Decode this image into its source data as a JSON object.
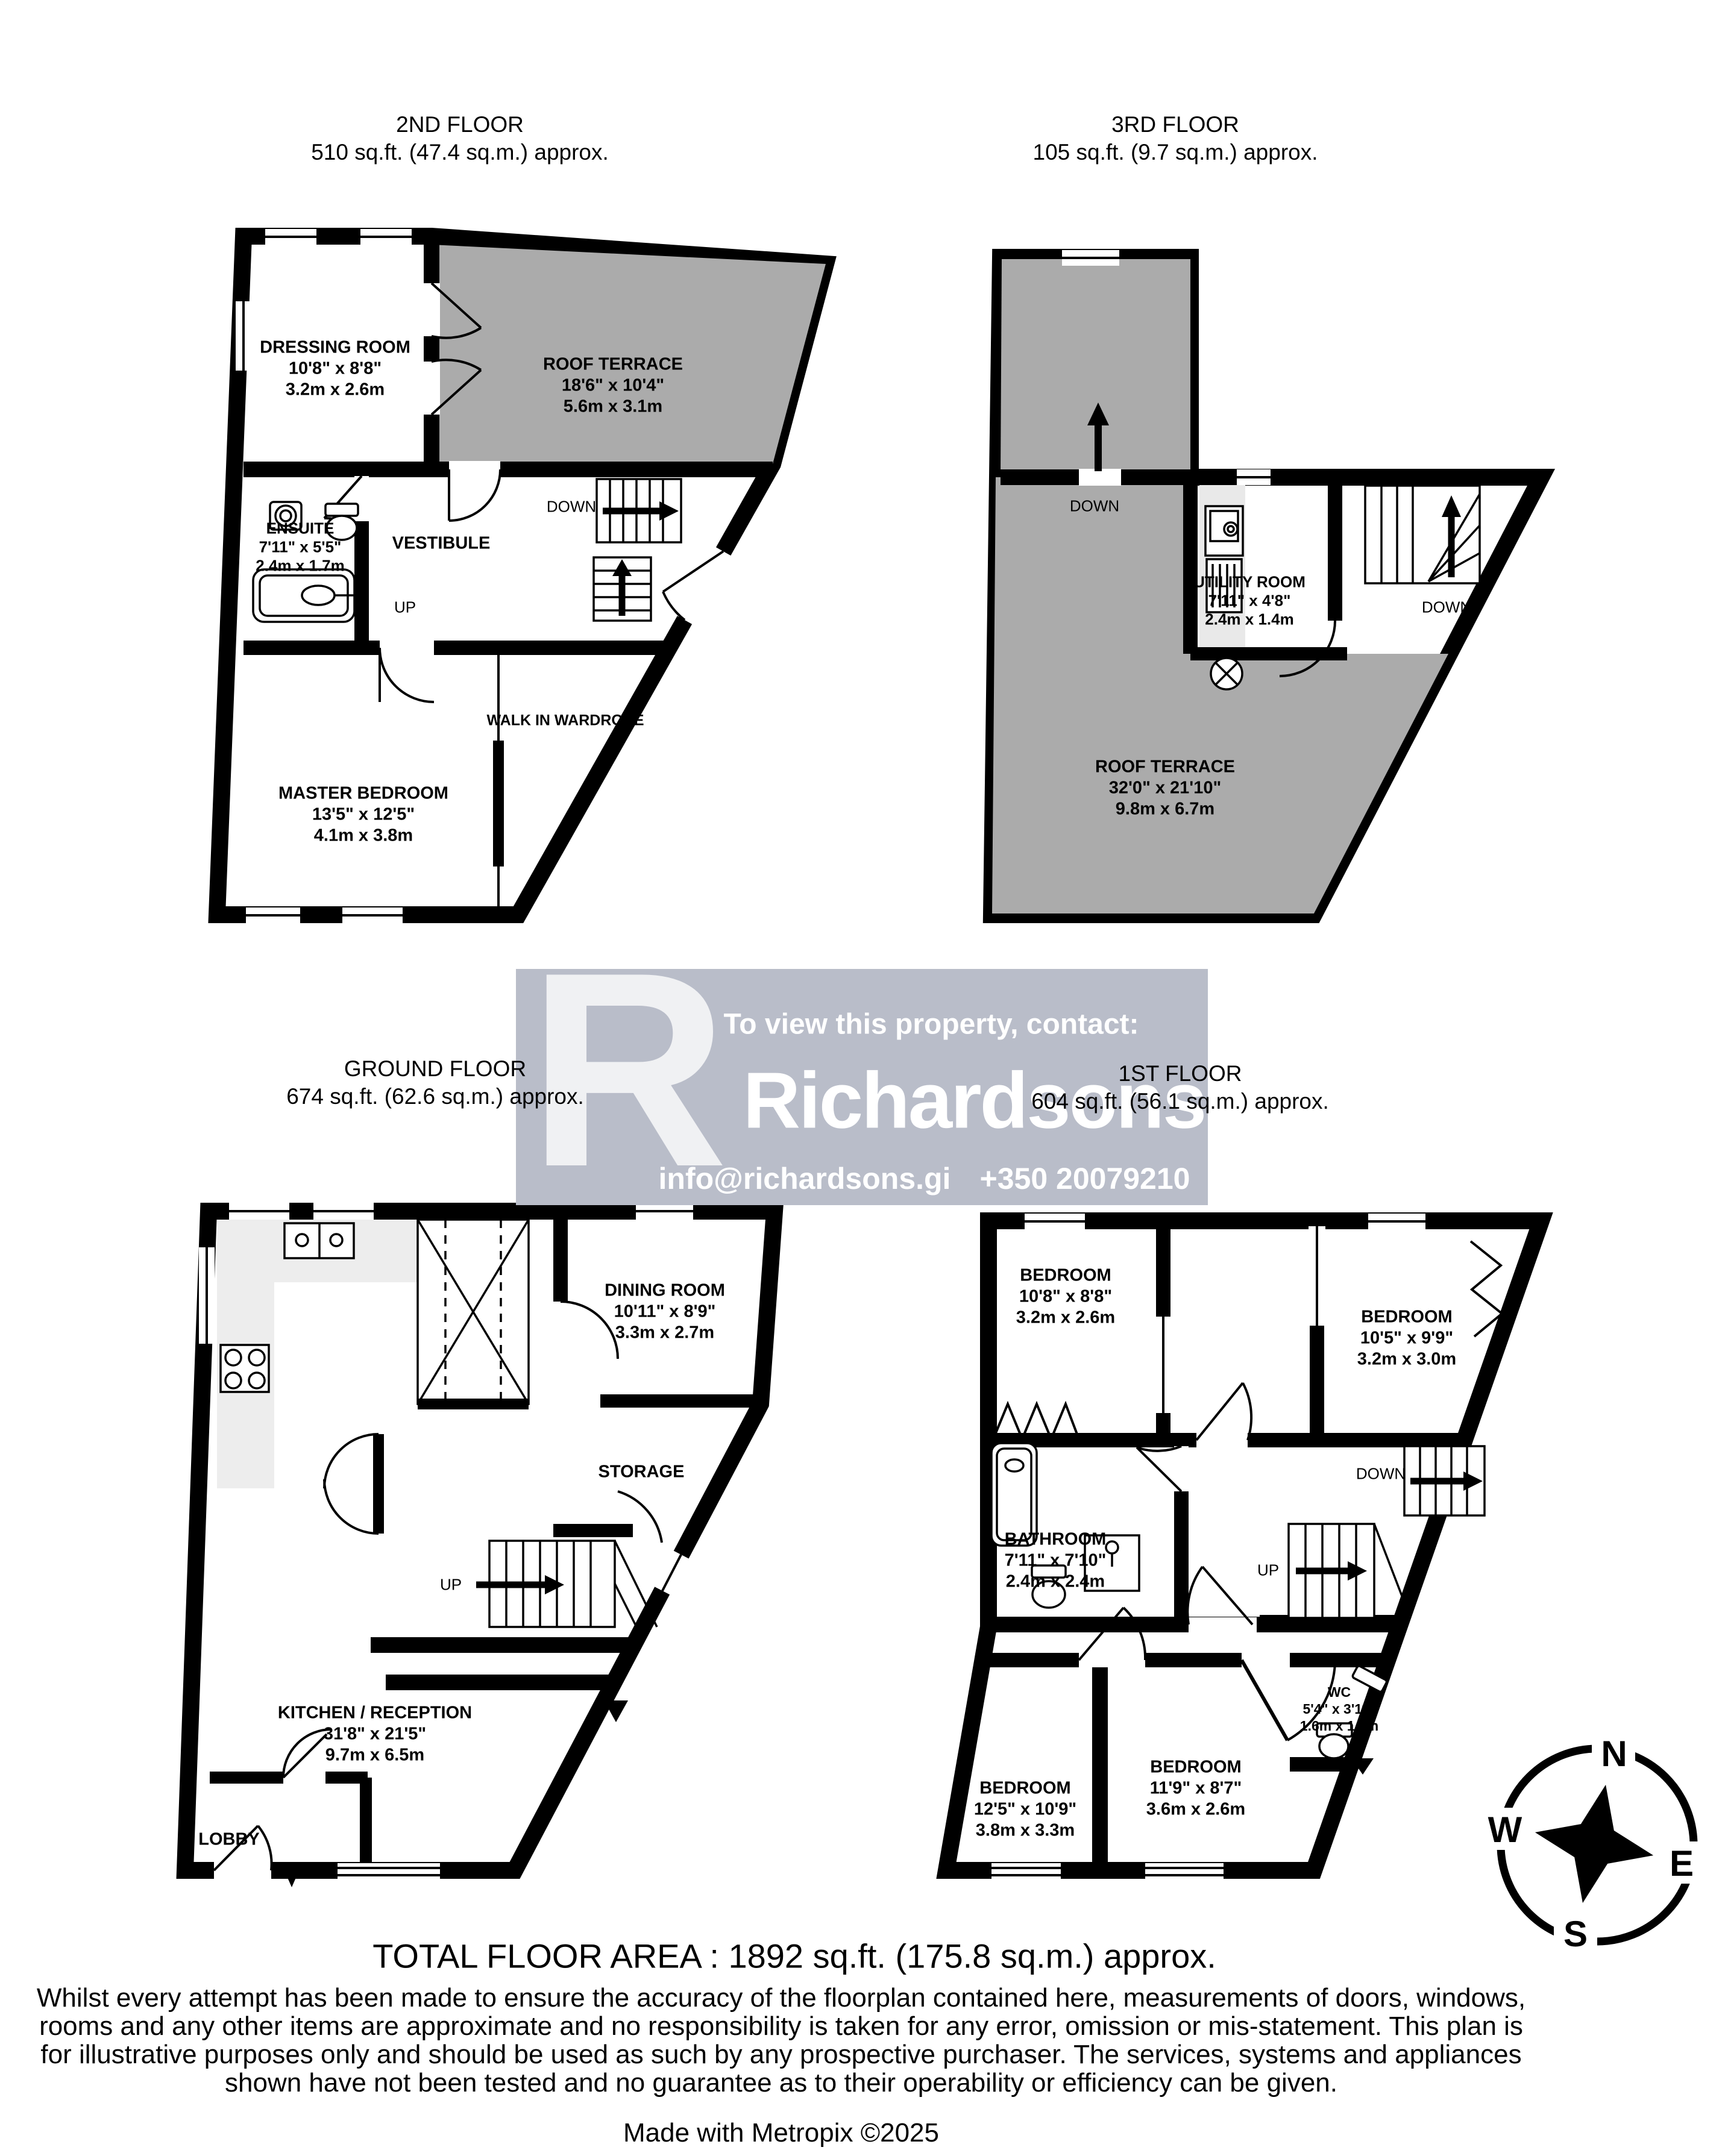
{
  "floors": [
    {
      "label": "2ND FLOOR",
      "area": "510 sq.ft. (47.4 sq.m.) approx.",
      "rooms": {
        "dressing": {
          "name": "DRESSING ROOM",
          "ft": "10'8\"  x 8'8\"",
          "m": "3.2m  x 2.6m"
        },
        "terrace": {
          "name": "ROOF TERRACE",
          "ft": "18'6\"  x 10'4\"",
          "m": "5.6m  x 3.1m"
        },
        "ensuite": {
          "name": "ENSUITE",
          "ft": "7'11\"  x 5'5\"",
          "m": "2.4m  x 1.7m"
        },
        "vestibule": {
          "name": "VESTIBULE"
        },
        "wardrobe": {
          "name": "WALK IN WARDROBE"
        },
        "master": {
          "name": "MASTER BEDROOM",
          "ft": "13'5\"  x 12'5\"",
          "m": "4.1m  x 3.8m"
        }
      },
      "annotations": {
        "down": "DOWN",
        "up": "UP"
      }
    },
    {
      "label": "3RD FLOOR",
      "area": "105 sq.ft. (9.7 sq.m.) approx.",
      "rooms": {
        "utility": {
          "name": "UTILITY ROOM",
          "ft": "7'11\"  x 4'8\"",
          "m": "2.4m  x 1.4m"
        },
        "terrace": {
          "name": "ROOF TERRACE",
          "ft": "32'0\"  x 21'10\"",
          "m": "9.8m  x 6.7m"
        }
      },
      "annotations": {
        "down1": "DOWN",
        "down2": "DOWN"
      }
    },
    {
      "label": "GROUND FLOOR",
      "area": "674 sq.ft. (62.6 sq.m.) approx.",
      "rooms": {
        "dining": {
          "name": "DINING ROOM",
          "ft": "10'11\"  x 8'9\"",
          "m": "3.3m  x 2.7m"
        },
        "storage": {
          "name": "STORAGE"
        },
        "kitchen": {
          "name": "KITCHEN / RECEPTION",
          "ft": "31'8\"  x 21'5\"",
          "m": "9.7m  x 6.5m"
        },
        "lobby": {
          "name": "LOBBY"
        }
      },
      "annotations": {
        "up": "UP"
      }
    },
    {
      "label": "1ST FLOOR",
      "area": "604 sq.ft. (56.1 sq.m.) approx.",
      "rooms": {
        "bed_tl": {
          "name": "BEDROOM",
          "ft": "10'8\"  x 8'8\"",
          "m": "3.2m  x 2.6m"
        },
        "bed_tr": {
          "name": "BEDROOM",
          "ft": "10'5\"  x 9'9\"",
          "m": "3.2m  x 3.0m"
        },
        "bathroom": {
          "name": "BATHROOM",
          "ft": "7'11\"  x 7'10\"",
          "m": "2.4m  x 2.4m"
        },
        "wc": {
          "name": "WC",
          "ft": "5'4\"  x 3'11\"",
          "m": "1.6m  x 1.2m"
        },
        "bed_bl": {
          "name": "BEDROOM",
          "ft": "12'5\"  x 10'9\"",
          "m": "3.8m  x 3.3m"
        },
        "bed_br": {
          "name": "BEDROOM",
          "ft": "11'9\"  x 8'7\"",
          "m": "3.6m  x 2.6m"
        }
      },
      "annotations": {
        "up": "UP",
        "down": "DOWN"
      }
    }
  ],
  "banner": {
    "logo_letter": "R",
    "heading": "To view this property, contact:",
    "brand": "Richardsons",
    "email": "info@richardsons.gi",
    "phone": "+350 20079210"
  },
  "footer": {
    "total": "TOTAL FLOOR AREA : 1892 sq.ft. (175.8 sq.m.) approx.",
    "disclaimer": "Whilst every attempt has been made to ensure the accuracy of the floorplan contained here, measurements of doors, windows, rooms and any other items are approximate and no responsibility is taken for any error, omission or mis-statement. This plan is for illustrative purposes only and should be used as such by any prospective purchaser. The services, systems and appliances shown have not been tested and no guarantee as to their operability or efficiency can be given.",
    "credit": "Made with Metropix ©2025"
  },
  "compass": {
    "n": "N",
    "e": "E",
    "s": "S",
    "w": "W"
  },
  "colors": {
    "terrace_gray": "#ababab",
    "banner_bg": "#b9bdc9",
    "counter_gray": "#ededed",
    "wall": "#000000"
  }
}
